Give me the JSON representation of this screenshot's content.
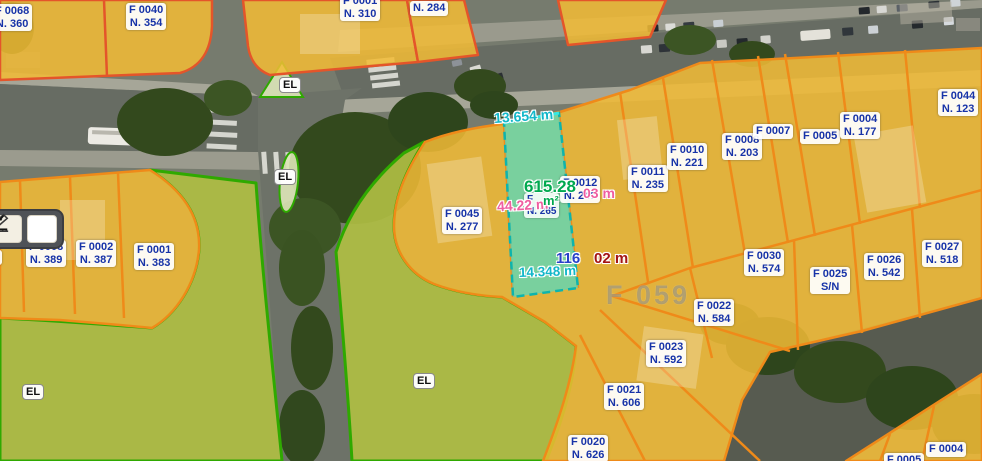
{
  "app": {
    "type": "cadastral-map-viewer"
  },
  "toolbar": {
    "buttons": [
      {
        "name": "measure-distance",
        "icon": "ruler-icon"
      },
      {
        "name": "measure-angle",
        "icon": "angle-icon"
      }
    ]
  },
  "map": {
    "watermark": "F 059",
    "el_label": "EL",
    "highlight": {
      "area_value": "615.28",
      "area_unit": "m²",
      "covered_label": {
        "line1": "F",
        "line2": "N. 265"
      },
      "dim_top": "13.654 m",
      "dim_left": "44.22 m",
      "dim_right_fragment": "03 m",
      "dim_bottom_blue": "116",
      "dim_bottom_red": "02 m",
      "dim_bottom_teal": "14.348 m"
    },
    "parcels": [
      {
        "f": "F 0068",
        "n": "N. 360"
      },
      {
        "f": "F 0040",
        "n": "N. 354"
      },
      {
        "f": "F 0001",
        "n": "N. 310"
      },
      {
        "f": "",
        "n": "N. 284"
      },
      {
        "f": "F 0045",
        "n": "N. 277"
      },
      {
        "f": "F 0012",
        "n": "N. 249"
      },
      {
        "f": "F 0011",
        "n": "N. 235"
      },
      {
        "f": "F 0010",
        "n": "N. 221"
      },
      {
        "f": "F 0008",
        "n": "N. 203"
      },
      {
        "f": "F 0007",
        "n": ""
      },
      {
        "f": "F 0005",
        "n": ""
      },
      {
        "f": "F 0004",
        "n": "N. 177"
      },
      {
        "f": "F 0044",
        "n": "N. 123"
      },
      {
        "f": "F 0003",
        "n": "N. 389"
      },
      {
        "f": "F 0002",
        "n": "N. 387"
      },
      {
        "f": "F 0001",
        "n": "N. 383"
      },
      {
        "f": "F 0030",
        "n": "N. 574"
      },
      {
        "f": "F 0025",
        "n": "S/N"
      },
      {
        "f": "F 0026",
        "n": "N. 542"
      },
      {
        "f": "F 0027",
        "n": "N. 518"
      },
      {
        "f": "F 0022",
        "n": "N. 584"
      },
      {
        "f": "F 0023",
        "n": "N. 592"
      },
      {
        "f": "F 0021",
        "n": "N. 606"
      },
      {
        "f": "F 0020",
        "n": "N. 626"
      },
      {
        "f": "F 0004",
        "n": ""
      },
      {
        "f": "F 0005",
        "n": ""
      },
      {
        "f": "",
        "n": "7"
      }
    ],
    "colors": {
      "parcel_fill": "#f2bc35",
      "parcel_border": "#ef8a19",
      "block_border_red": "#e4552a",
      "green_fill": "#aebc43",
      "green_border": "#2fa900",
      "highlight_fill": "#48decd",
      "highlight_border": "#0db4ad",
      "label_text": "#1733a8",
      "measure_teal": "#12b7c9",
      "measure_pink": "#ef5ea1",
      "measure_green": "#00a94f",
      "measure_blue": "#2741c9",
      "measure_red": "#a31515"
    }
  }
}
